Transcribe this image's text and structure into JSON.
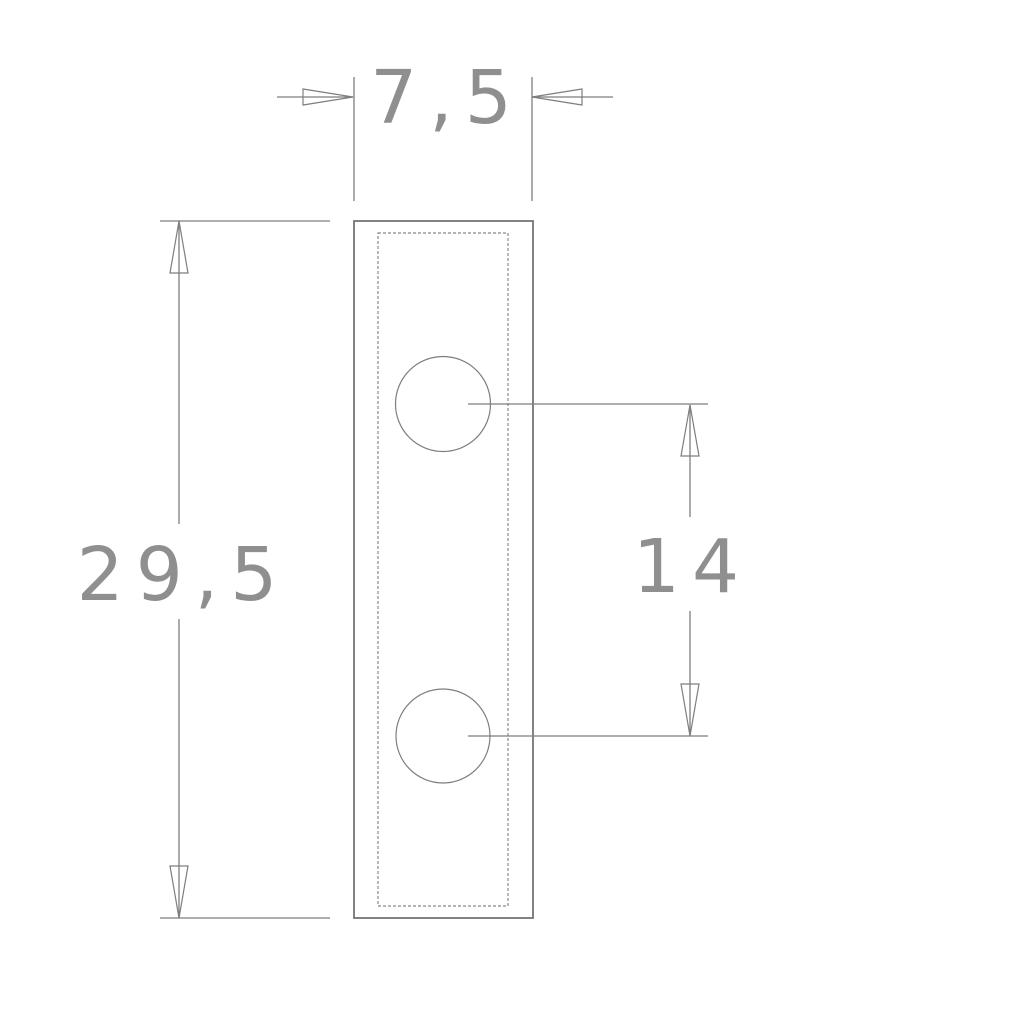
{
  "drawing": {
    "kind": "technical-drawing",
    "holes_count": 2
  },
  "dimensions": {
    "width": {
      "label": "7,5",
      "value": 7.5
    },
    "height": {
      "label": "29,5",
      "value": 29.5
    },
    "hole_spacing": {
      "label": "14",
      "value": 14
    }
  },
  "colors": {
    "background": "#ffffff",
    "line": "#7e7e7e",
    "outline": "#6c6c6c",
    "text": "#8f8f8f"
  }
}
